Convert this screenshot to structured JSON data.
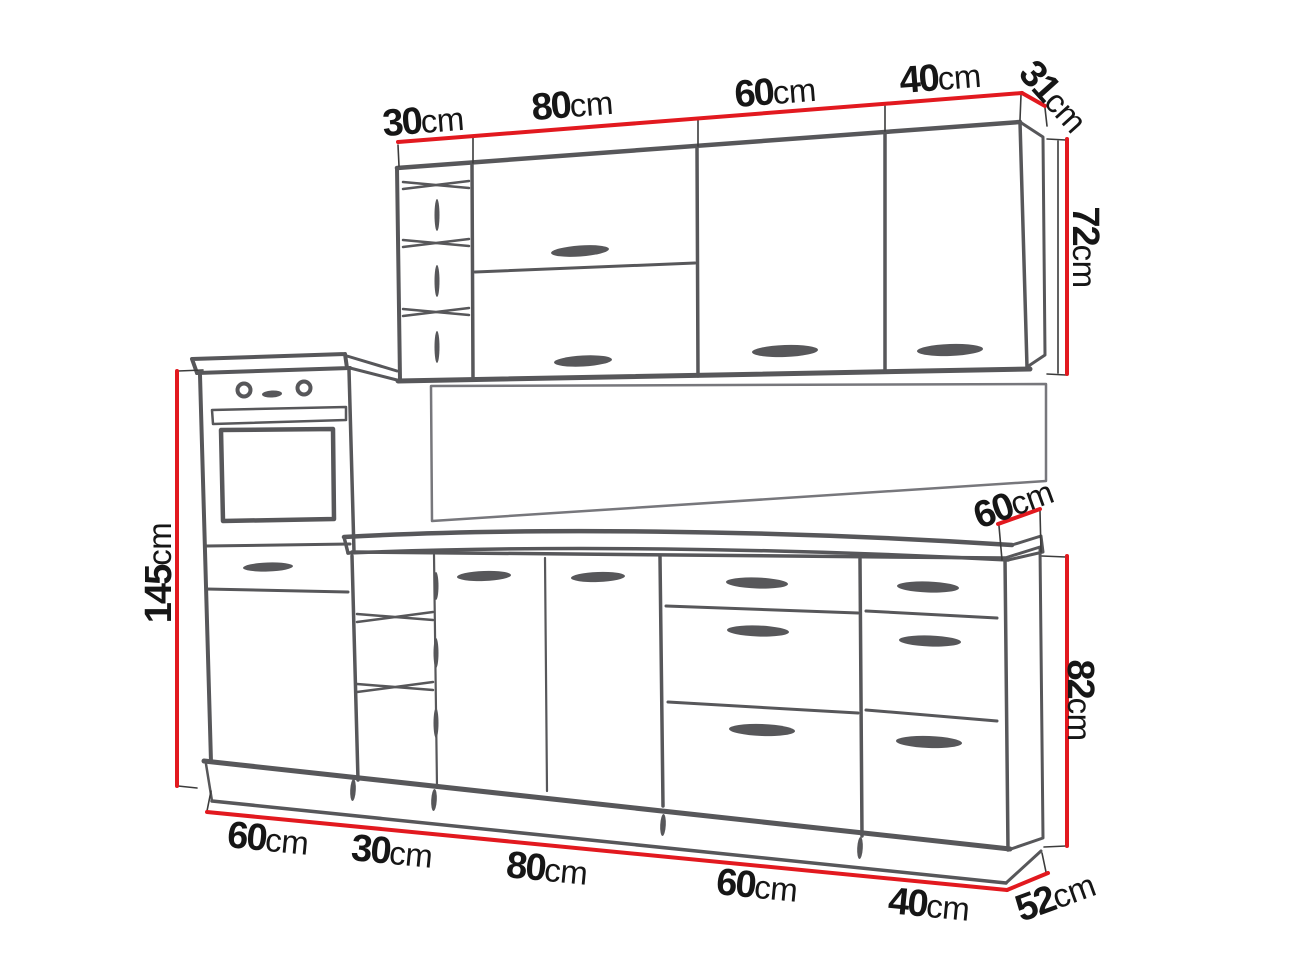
{
  "diagram": {
    "type": "kitchen furniture set dimension drawing",
    "unit": "cm",
    "colors": {
      "dimension_line": "#e2191f",
      "sketch_line": "#57575a",
      "label_text": "#161616",
      "background": "#ffffff"
    },
    "upper_cabinets": {
      "section_widths": [
        {
          "value": "30",
          "unit": "cm"
        },
        {
          "value": "80",
          "unit": "cm"
        },
        {
          "value": "60",
          "unit": "cm"
        },
        {
          "value": "40",
          "unit": "cm"
        }
      ],
      "depth": {
        "value": "31",
        "unit": "cm"
      },
      "height": {
        "value": "72",
        "unit": "cm"
      }
    },
    "base_cabinets": {
      "tall_cabinet_height": {
        "value": "145",
        "unit": "cm"
      },
      "section_widths": [
        {
          "value": "60",
          "unit": "cm"
        },
        {
          "value": "30",
          "unit": "cm"
        },
        {
          "value": "80",
          "unit": "cm"
        },
        {
          "value": "60",
          "unit": "cm"
        },
        {
          "value": "40",
          "unit": "cm"
        }
      ],
      "worktop_depth": {
        "value": "60",
        "unit": "cm"
      },
      "height": {
        "value": "82",
        "unit": "cm"
      },
      "depth": {
        "value": "52",
        "unit": "cm"
      }
    }
  }
}
